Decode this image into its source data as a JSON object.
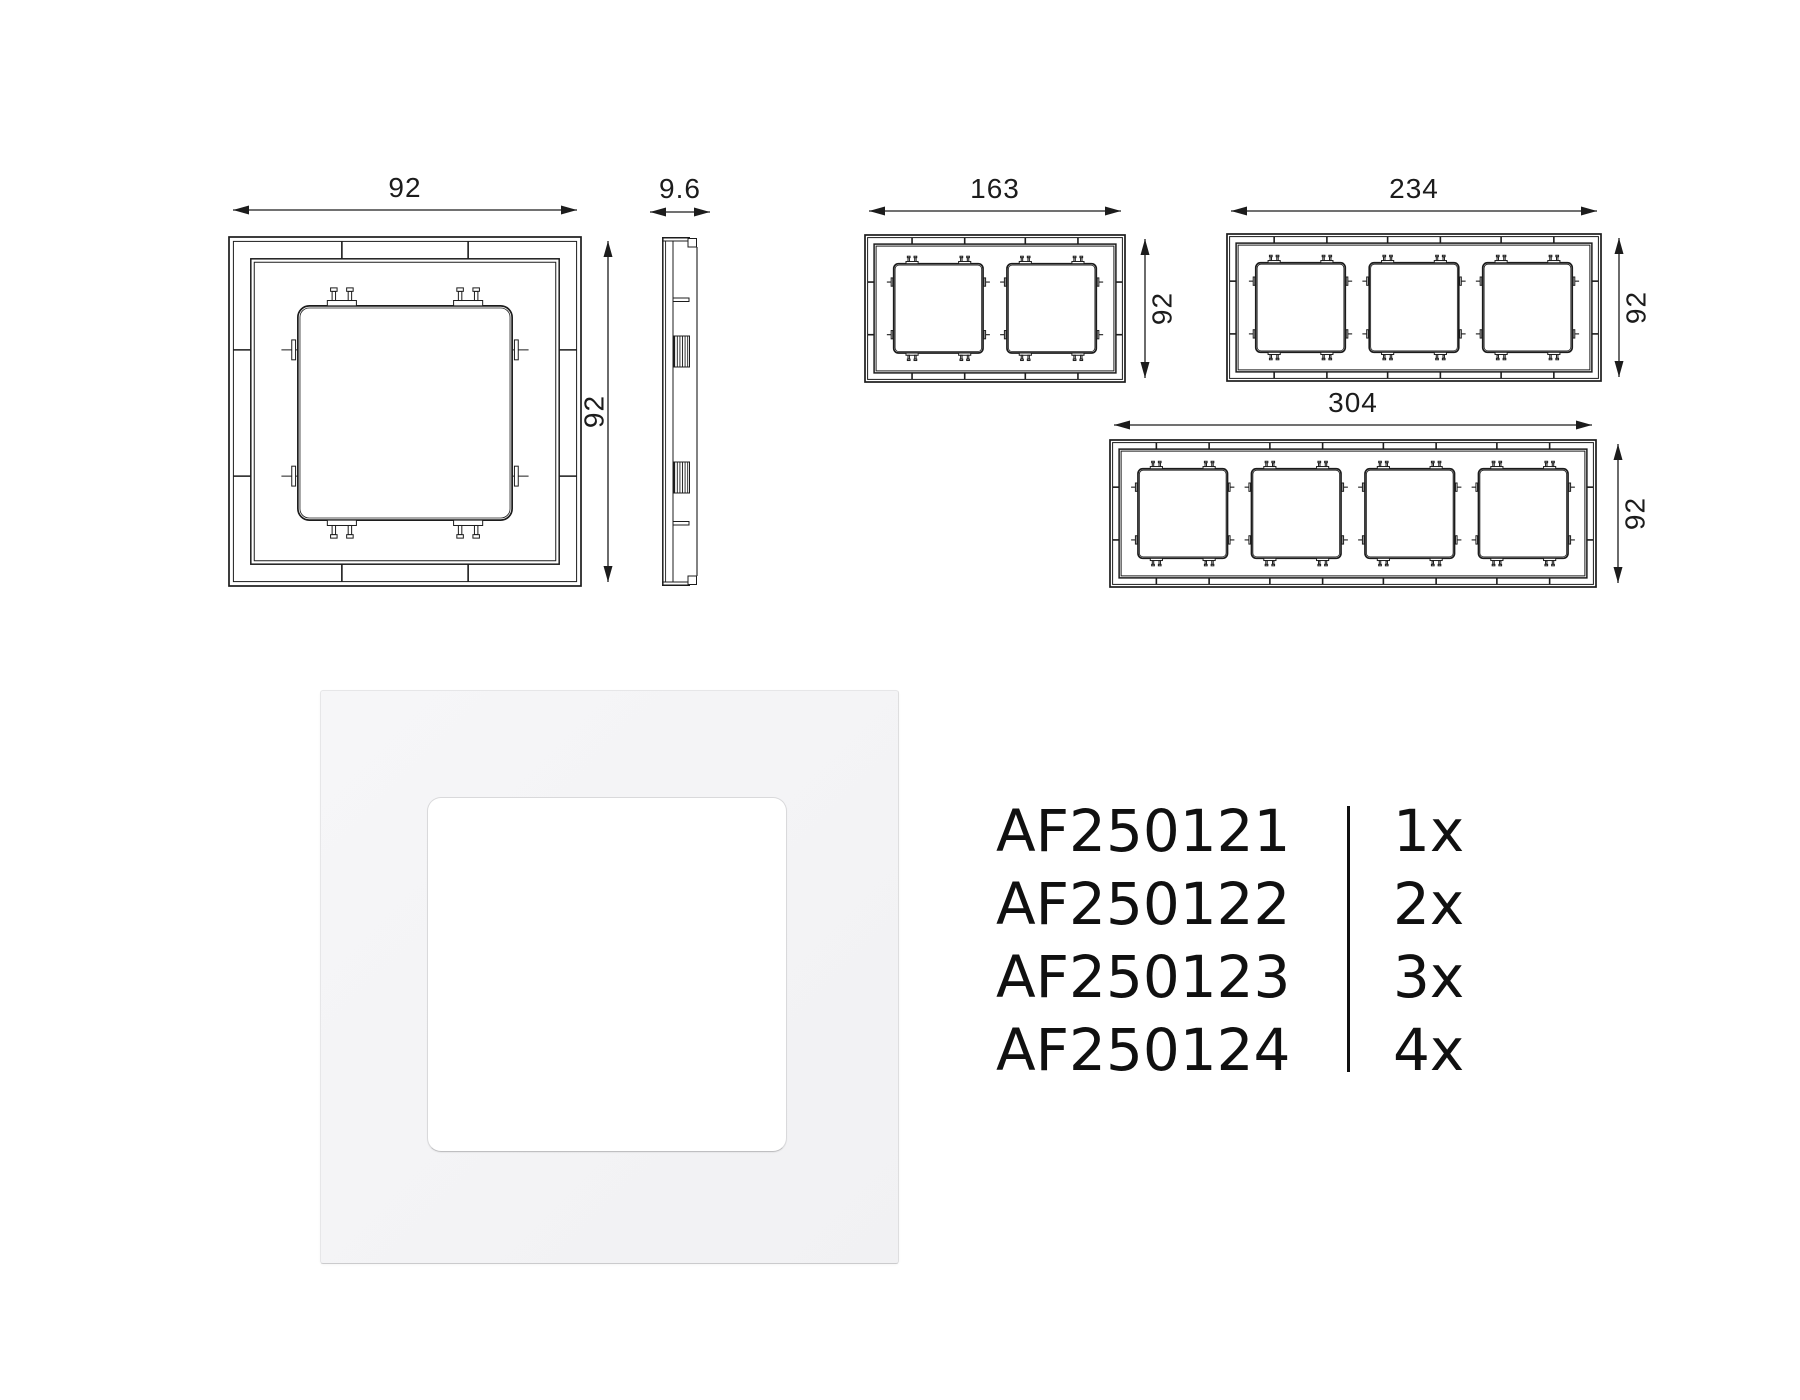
{
  "colors": {
    "line": "#1c1c1c",
    "text": "#101010",
    "photo_frame": "#f3f3f5",
    "photo_window": "#ffffff"
  },
  "drawings": {
    "units": "mm",
    "front_views": [
      {
        "id": "frame-1-gang",
        "gangs": 1,
        "width_mm": 92,
        "width_label": "92",
        "height_label": "92",
        "box": {
          "x": 229,
          "y": 237,
          "w": 352,
          "h": 349
        },
        "top_dim": {
          "y": 210
        },
        "right_dim": {
          "x": 608,
          "label_side": "left"
        }
      },
      {
        "id": "frame-2-gang",
        "gangs": 2,
        "width_mm": 163,
        "width_label": "163",
        "height_label": "92",
        "box": {
          "x": 865,
          "y": 235,
          "w": 260,
          "h": 147
        },
        "top_dim": {
          "y": 211
        },
        "right_dim": {
          "x": 1145,
          "label_side": "right"
        }
      },
      {
        "id": "frame-3-gang",
        "gangs": 3,
        "width_mm": 234,
        "width_label": "234",
        "height_label": "92",
        "box": {
          "x": 1227,
          "y": 234,
          "w": 374,
          "h": 147
        },
        "top_dim": {
          "y": 211
        },
        "right_dim": {
          "x": 1619,
          "label_side": "right"
        }
      },
      {
        "id": "frame-4-gang",
        "gangs": 4,
        "width_mm": 304,
        "width_label": "304",
        "height_label": "92",
        "box": {
          "x": 1110,
          "y": 440,
          "w": 486,
          "h": 147
        },
        "top_dim": {
          "y": 425
        },
        "right_dim": {
          "x": 1618,
          "label_side": "right"
        }
      }
    ],
    "side_view": {
      "id": "side-view-1-gang",
      "depth_label": "9.6",
      "box": {
        "x": 662,
        "y": 237,
        "w": 36,
        "h": 349
      },
      "dim": {
        "y": 212,
        "x1": 650,
        "x2": 710
      }
    }
  },
  "parts_list": {
    "rows": [
      {
        "code": "AF250121",
        "qty": "1x"
      },
      {
        "code": "AF250122",
        "qty": "2x"
      },
      {
        "code": "AF250123",
        "qty": "3x"
      },
      {
        "code": "AF250124",
        "qty": "4x"
      }
    ]
  }
}
